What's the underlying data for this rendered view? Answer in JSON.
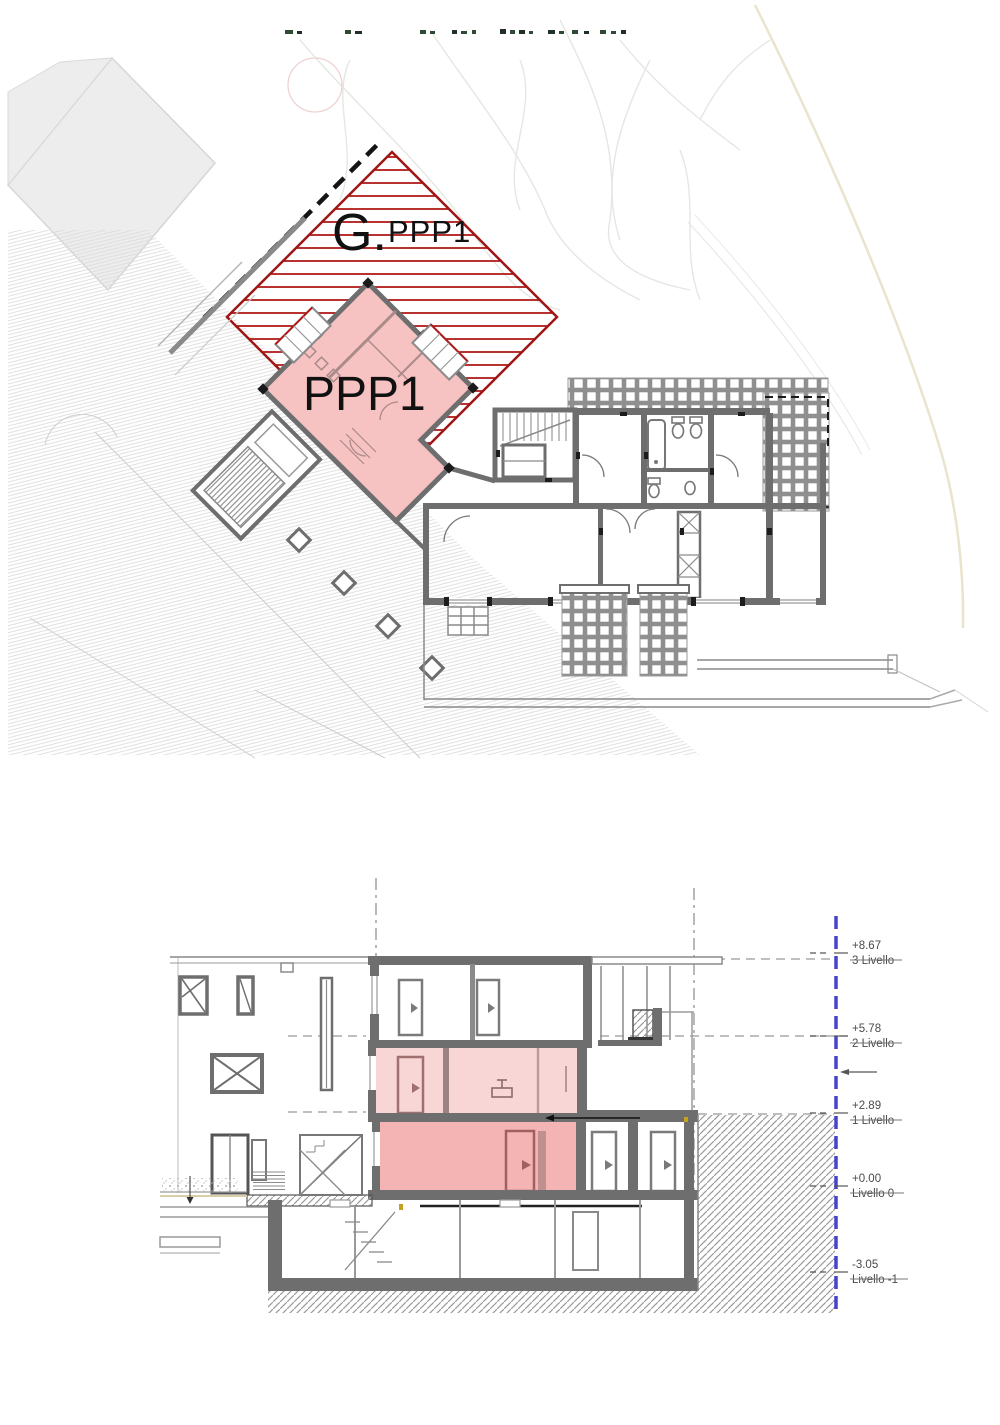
{
  "drawing": {
    "type": "architectural plan and section",
    "plan": {
      "garden_label_prefix": "G.",
      "garden_label_unit": "PPP1",
      "apartment_label": "PPP1",
      "colors": {
        "highlight_fill": "#f6c2c2",
        "garden_hatch_red": "#b01a1a",
        "wall_gray": "#6e6e6e"
      }
    },
    "section": {
      "levels": [
        {
          "value": "+8.67",
          "name": "3 Livello"
        },
        {
          "value": "+5.78",
          "name": "2 Livello"
        },
        {
          "value": "+2.89",
          "name": "1 Livello"
        },
        {
          "value": "+0.00",
          "name": "Livello 0"
        },
        {
          "value": "-3.05",
          "name": "Livello -1"
        }
      ],
      "colors": {
        "level2_fill": "#f9d6d6",
        "level1_fill": "#f5b4b4",
        "boundary_blue": "#4444cc"
      }
    }
  }
}
